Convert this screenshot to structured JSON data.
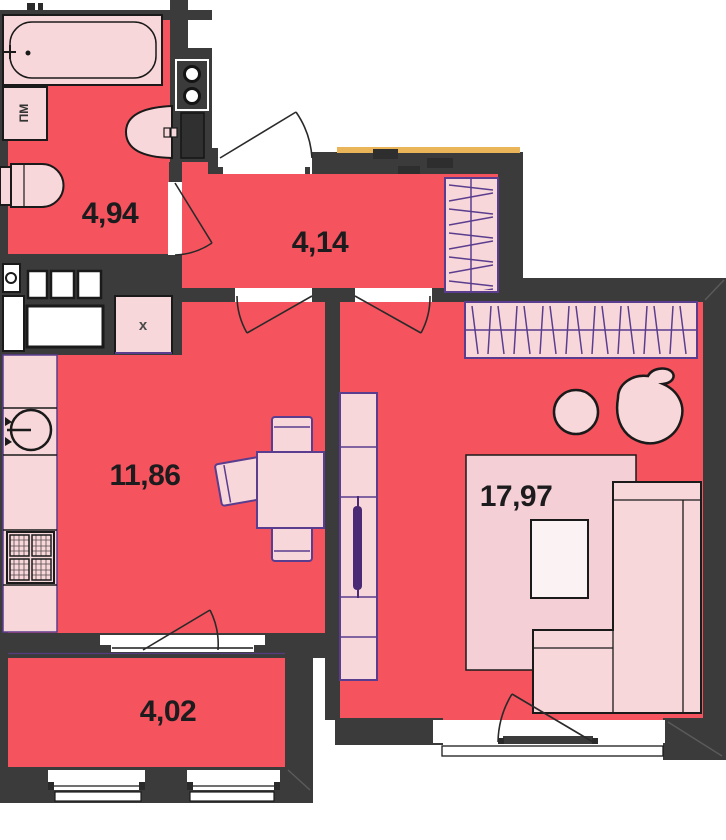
{
  "plan": {
    "rooms": [
      {
        "id": "bathroom",
        "area": "4,94"
      },
      {
        "id": "hallway",
        "area": "4,14"
      },
      {
        "id": "kitchen",
        "area": "11,86"
      },
      {
        "id": "living-room",
        "area": "17,97"
      },
      {
        "id": "balcony",
        "area": "4,02"
      }
    ],
    "labels": {
      "washing_machine": "ПМ",
      "vent_box": "x"
    },
    "colors": {
      "floor": "#f5535d",
      "wall": "#3b3b3b",
      "fixture": "#f8d7da",
      "furniture_outline": "#5b3d8f",
      "sill_accent": "#e9b558"
    }
  }
}
